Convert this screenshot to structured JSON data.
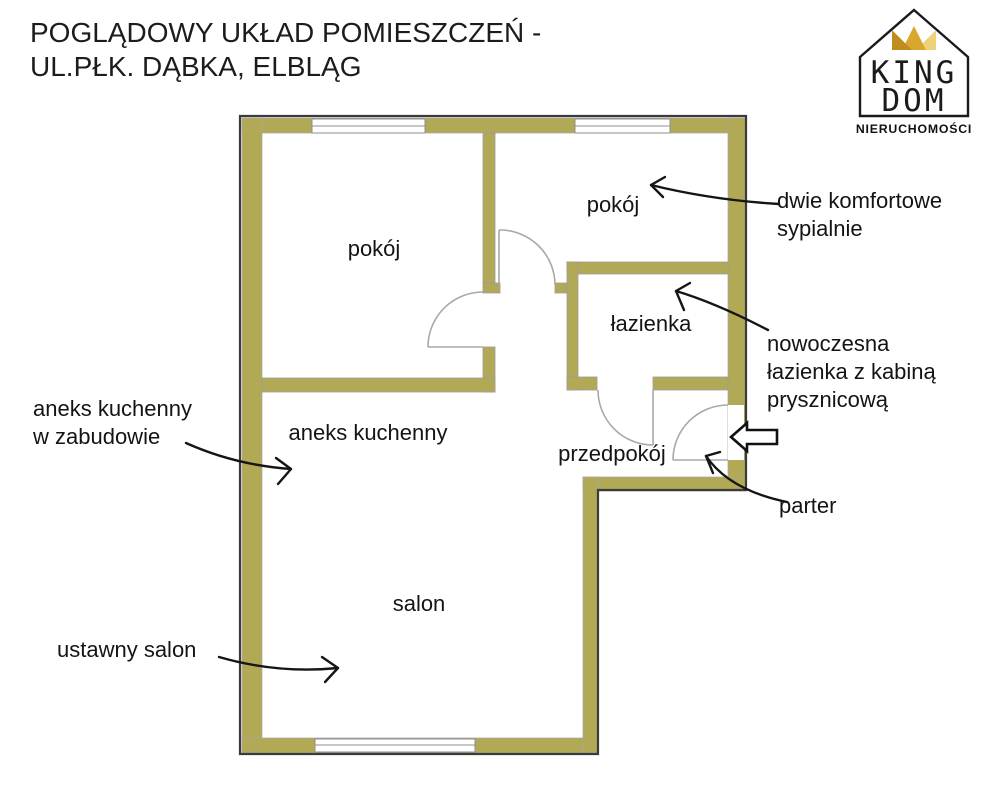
{
  "title": {
    "line1": "POGLĄDOWY UKŁAD POMIESZCZEŃ -",
    "line2": "UL.PŁK. DĄBKA, ELBLĄG"
  },
  "logo": {
    "word_top": "KING",
    "word_bottom": "DOM",
    "subtitle": "NIERUCHOMOŚCI"
  },
  "rooms": {
    "room_left": "pokój",
    "room_right": "pokój",
    "bathroom": "łazienka",
    "kitchenette": "aneks kuchenny",
    "hallway": "przedpokój",
    "living_room": "salon"
  },
  "annotations": {
    "bedrooms_line1": "dwie komfortowe",
    "bedrooms_line2": "sypialnie",
    "bathroom_line1": "nowoczesna",
    "bathroom_line2": "łazienka z kabiną",
    "bathroom_line3": "prysznicową",
    "kitchen_line1": "aneks kuchenny",
    "kitchen_line2": "w zabudowie",
    "floor_level": "parter",
    "living": "ustawny salon"
  },
  "colors": {
    "wall_fill": "#b2a956",
    "wall_outline": "#3b3b3b",
    "door_line": "#a8a8a8",
    "crown_gold_dark": "#c08c1e",
    "crown_gold_mid": "#d9a62e",
    "crown_gold_light": "#eed27a",
    "text": "#141414"
  }
}
